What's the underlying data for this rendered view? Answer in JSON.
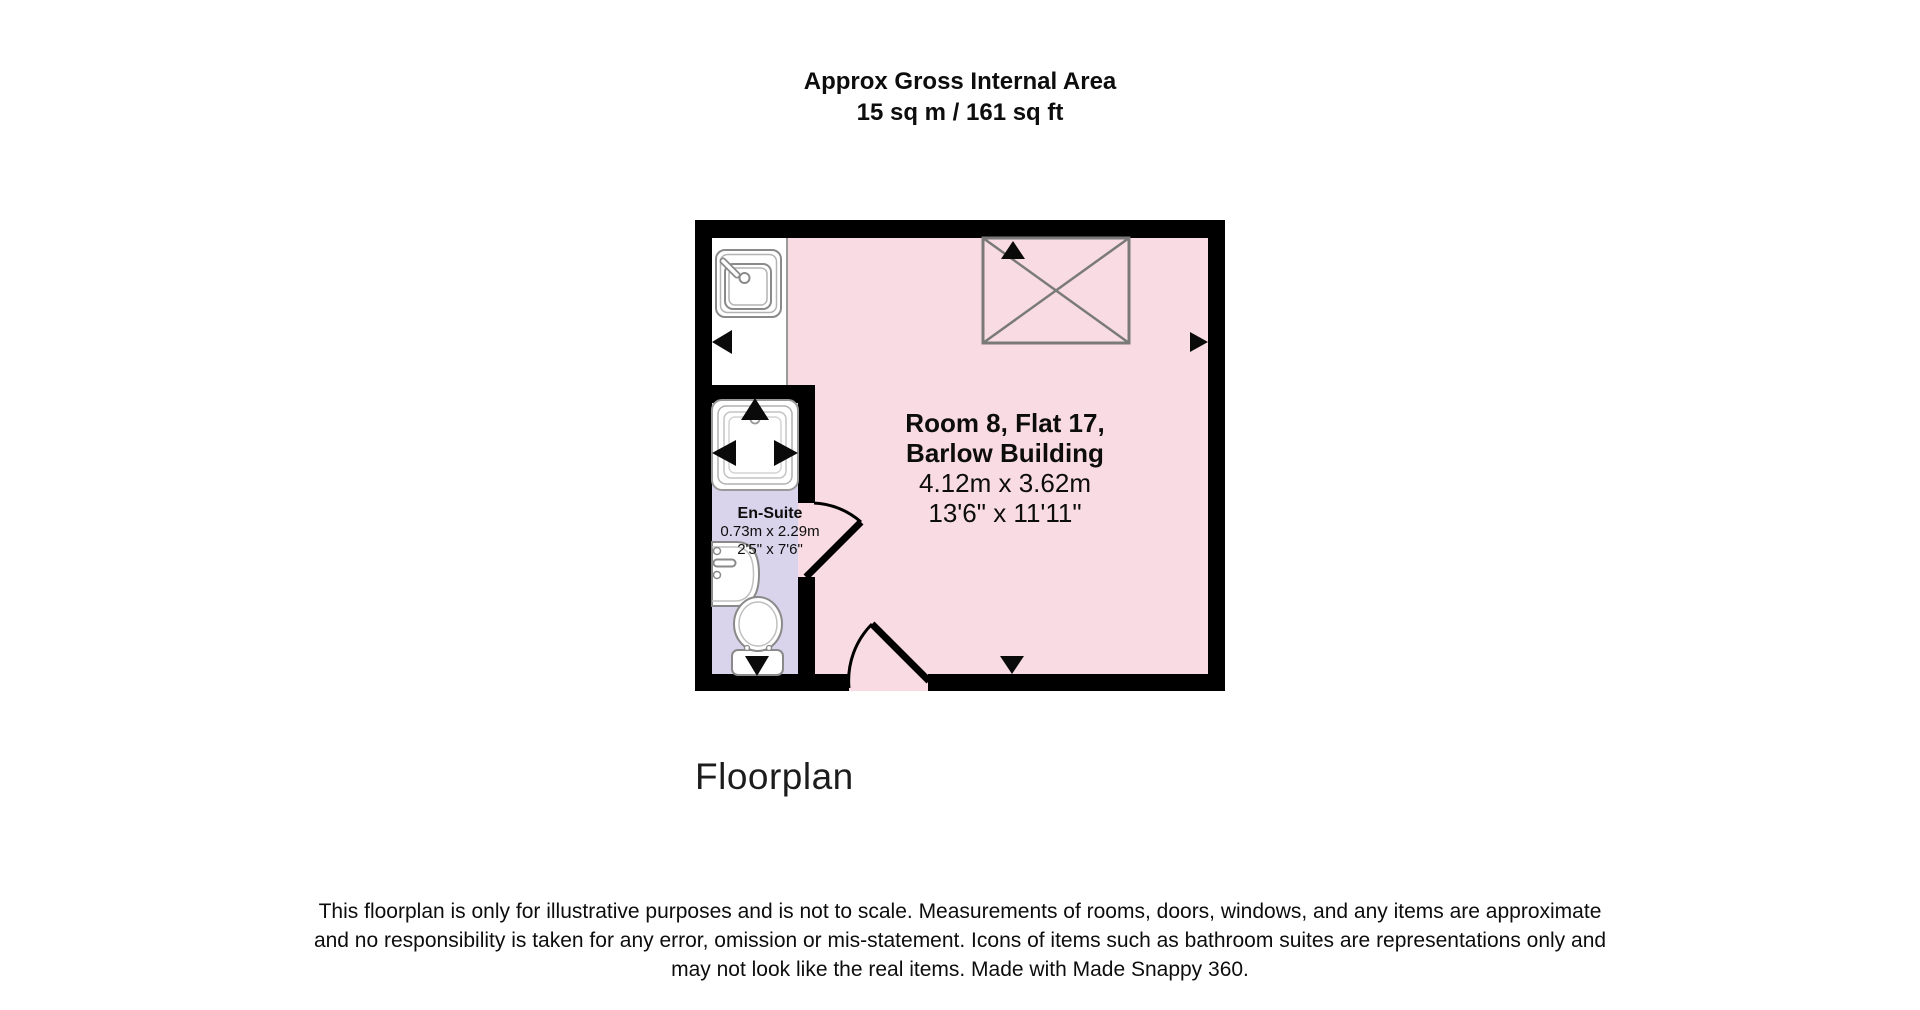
{
  "title": {
    "line1": "Approx Gross Internal Area",
    "line2": "15 sq m / 161 sq ft"
  },
  "floorplan": {
    "main_room": {
      "name_line1": "Room 8, Flat 17,",
      "name_line2": "Barlow Building",
      "dims_metric": "4.12m x 3.62m",
      "dims_imperial": "13'6\" x 11'11\""
    },
    "ensuite": {
      "name": "En-Suite",
      "dims_metric": "0.73m x 2.29m",
      "dims_imperial": "2'5\" x 7'6\""
    },
    "icons": {
      "kitchen_sink": "kitchen-sink-icon",
      "shower": "shower-icon",
      "basin": "basin-icon",
      "toilet": "toilet-icon",
      "wardrobe": "wardrobe-x-box-icon",
      "door_swing": "door-swing-arc",
      "view_arrow": "view-direction-arrow"
    },
    "colors": {
      "room_fill": "#f9dce3",
      "ensuite_fill": "#d9d4eb",
      "wall": "#000000",
      "fixture_outline": "#8a8a8a",
      "wardrobe_outline": "#7a7a7a",
      "arrow": "#0a0a0a"
    }
  },
  "caption": "Floorplan",
  "disclaimer": {
    "line1": "This floorplan is only for illustrative purposes and is not to scale. Measurements of rooms, doors, windows, and any items are approximate",
    "line2": "and no responsibility is taken for any error, omission or mis-statement. Icons of items such as bathroom suites are representations only and",
    "line3": "may not look like the real items. Made with Made Snappy 360."
  }
}
